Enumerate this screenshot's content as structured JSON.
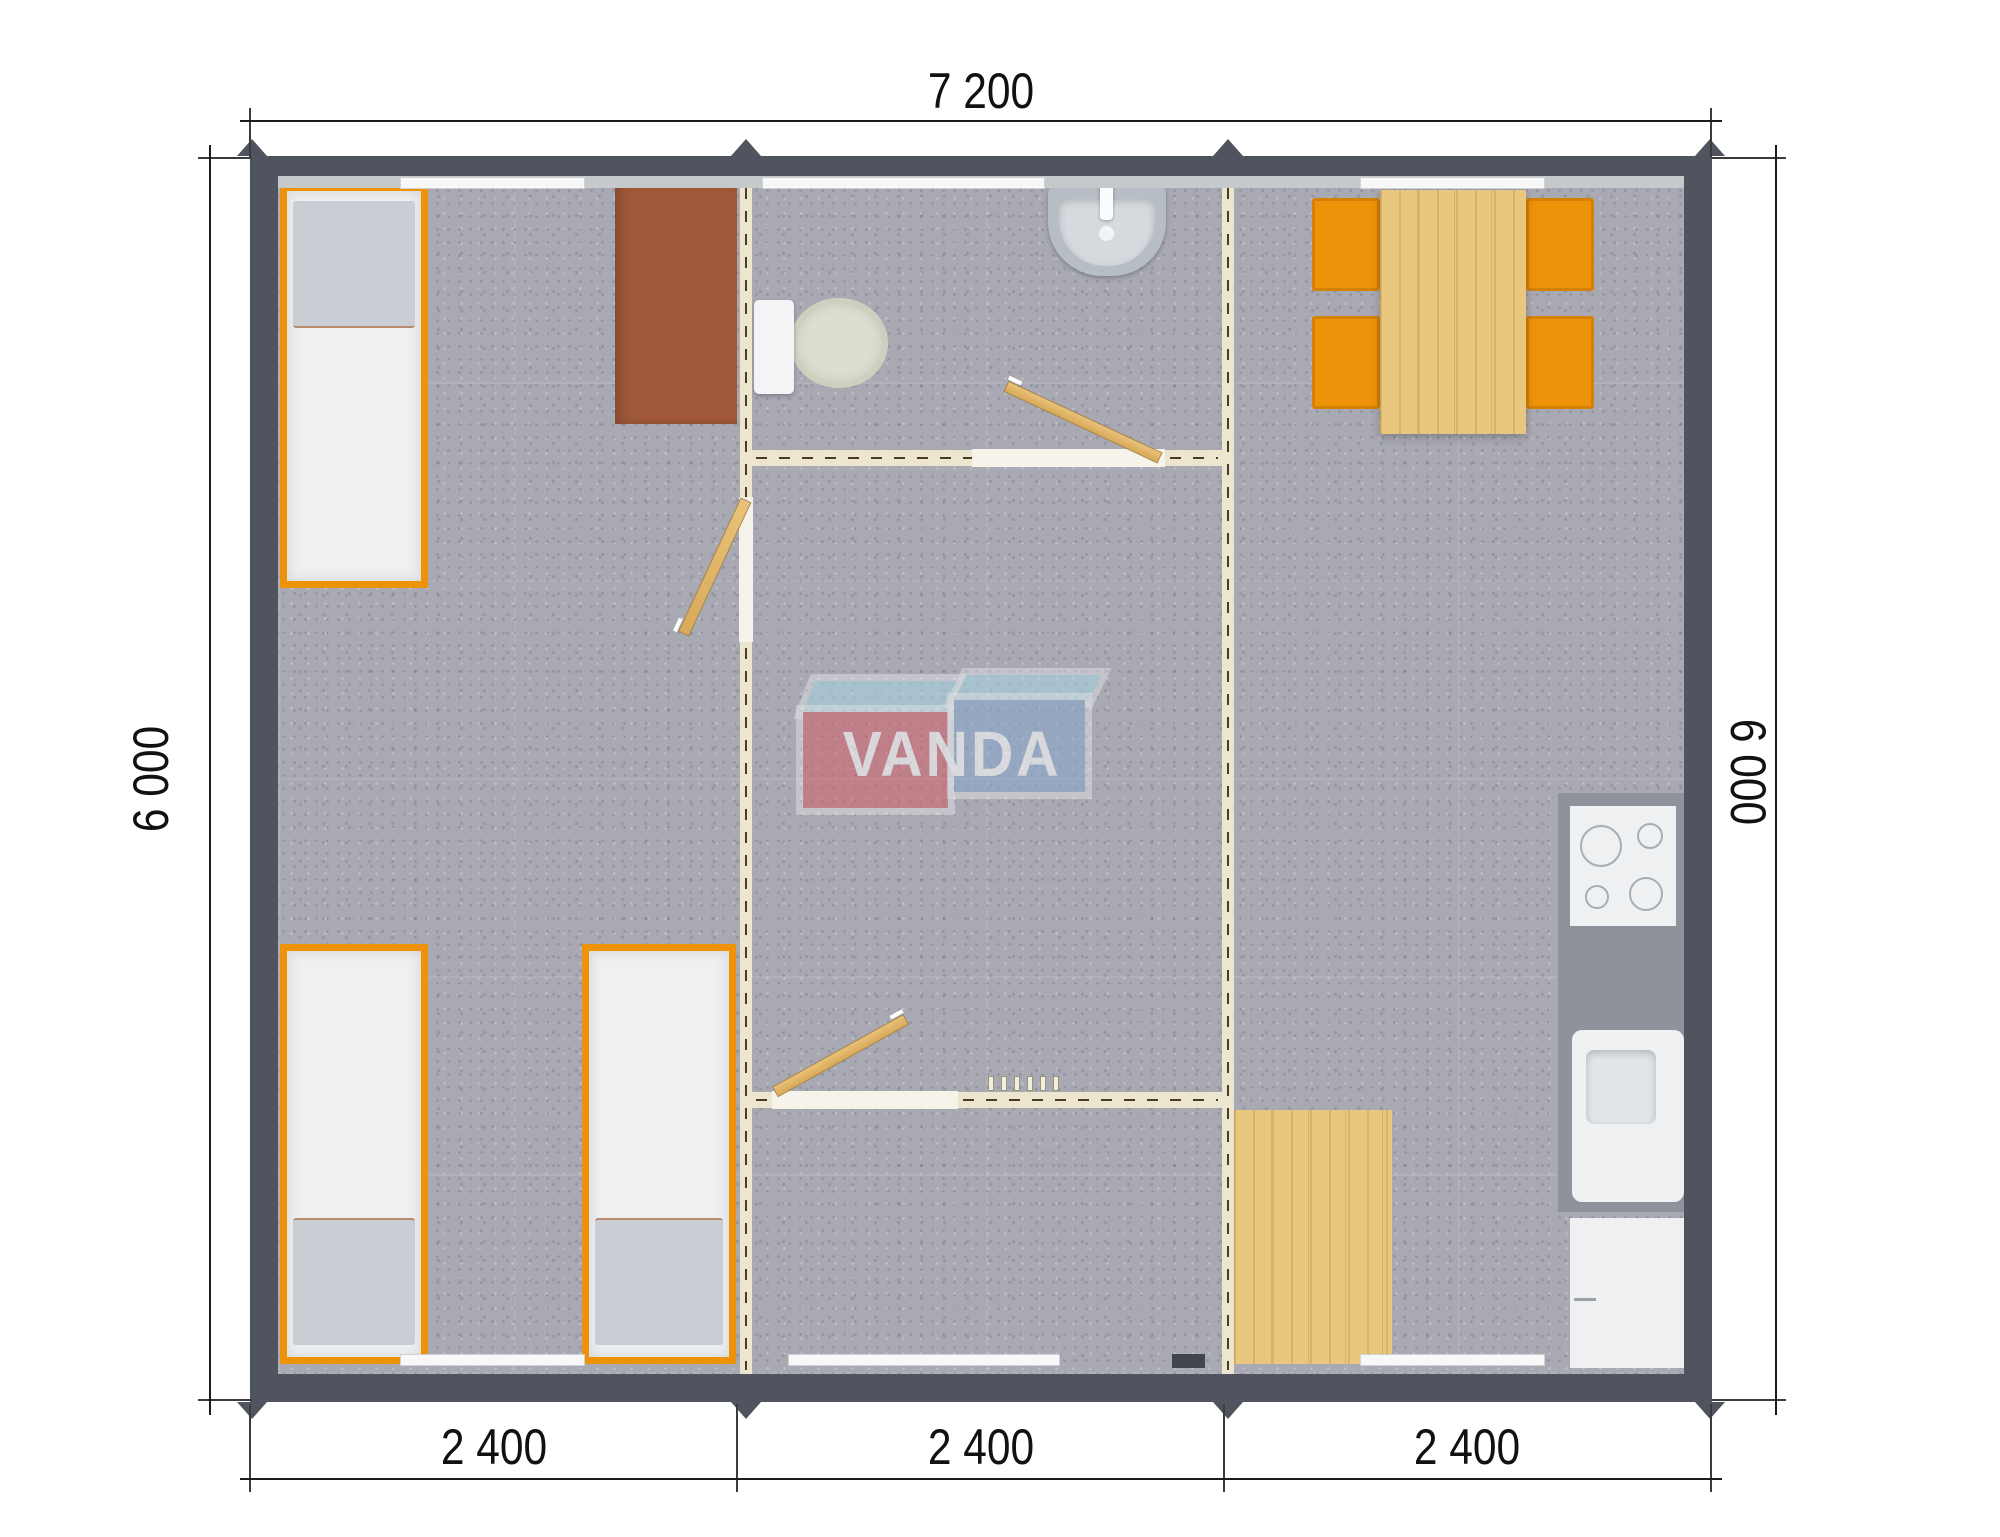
{
  "dimensions": {
    "top": "7 200",
    "left": "6 000",
    "right": "6 000",
    "bottom": [
      "2 400",
      "2 400",
      "2 400"
    ]
  },
  "logo": {
    "text": "VANDA"
  },
  "colors": {
    "wall": "#4f545e",
    "lining": "#c6c9cc",
    "floor": "#a8a9b2",
    "partition": "#ece6ce",
    "partition-dash": "#4a3a28",
    "accent-orange": "#ee9209",
    "wood": "#e9c77e",
    "desk-brown": "#a2593a",
    "furniture-white": "#eef0f2",
    "pillow-gray": "#c9ced4",
    "counter-gray": "#8e929a",
    "fixture-gray": "#b7bdc5",
    "logo-red": "#d1646c",
    "logo-blue": "#8aa8cc",
    "logo-sky": "#a7d4e3",
    "dim-line": "#1c1c1c"
  }
}
